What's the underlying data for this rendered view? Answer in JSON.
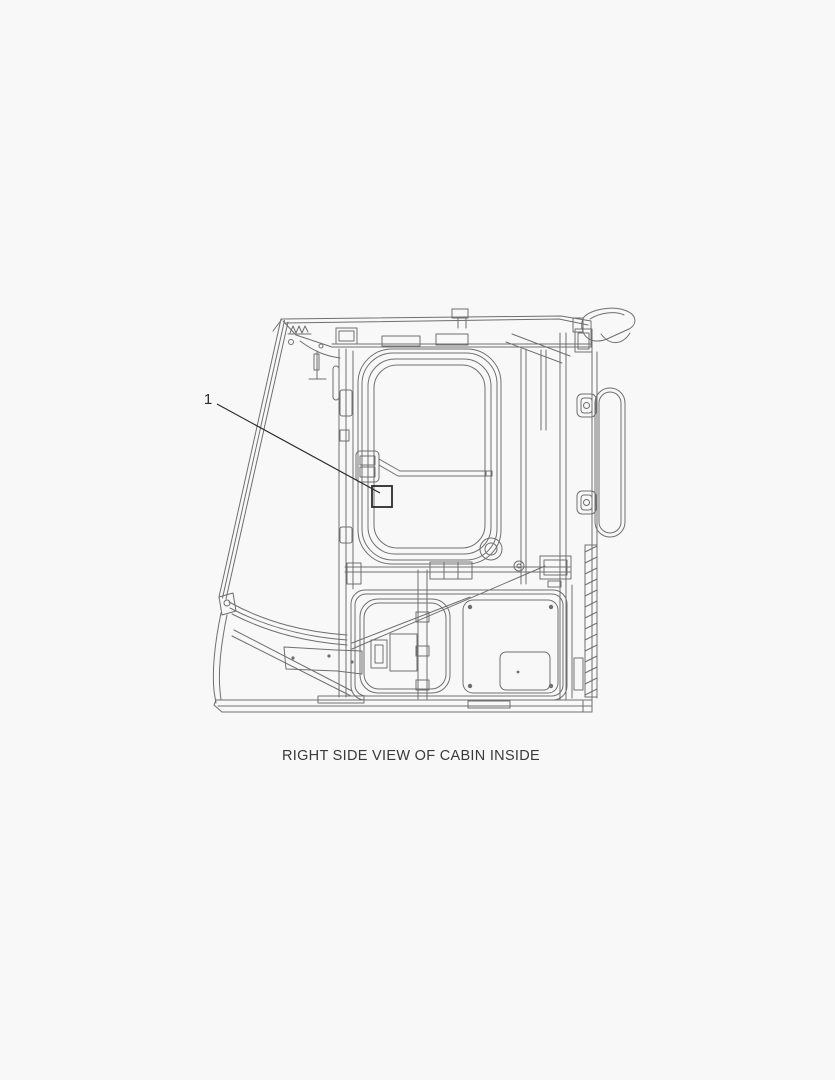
{
  "page": {
    "background": "#f8f8f8"
  },
  "diagram": {
    "caption": "RIGHT SIDE VIEW OF CABIN INSIDE",
    "callout": {
      "label": "1"
    },
    "colors": {
      "line": "#6f6f6f",
      "callout": "#2b2b2b",
      "caption_text": "#3a3a3a"
    }
  }
}
